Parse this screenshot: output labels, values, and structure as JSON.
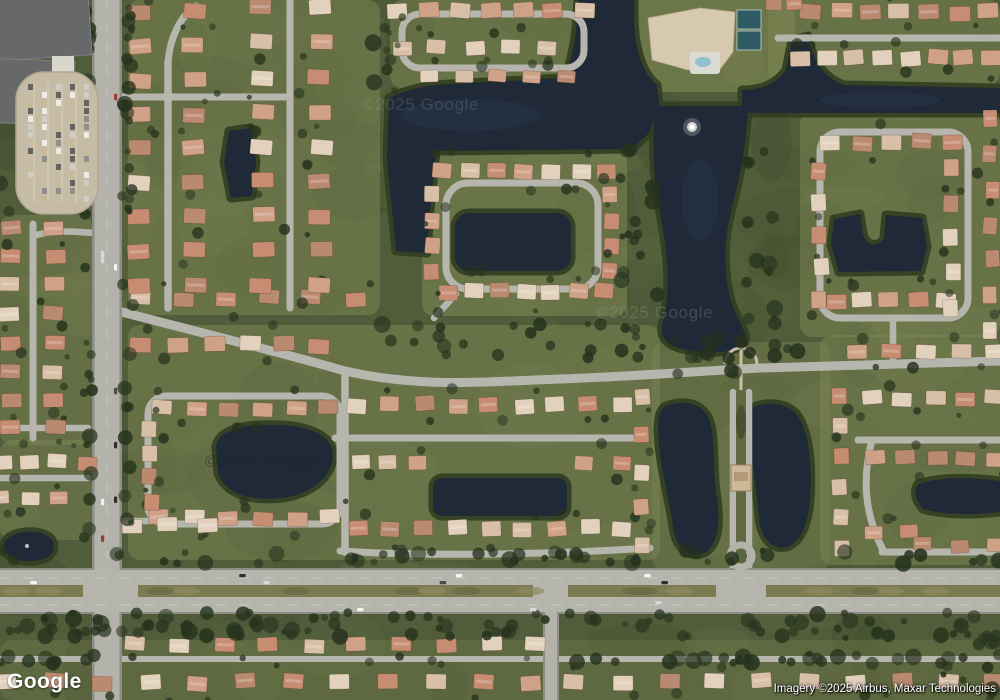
{
  "map": {
    "view_type": "satellite",
    "provider_logo": "Google",
    "attribution": "Imagery ©2025 Airbus, Maxar Technologies",
    "watermark": "©2025 Google",
    "palette": {
      "water": "#1f2937",
      "water_light": "#35425a",
      "shore": "#333f22",
      "vegetation": "#515c3a",
      "lawn": "#7e8854",
      "tree": "#26321d",
      "road": "#b7b6ae",
      "road_major": "#b4b3ab",
      "road_edge": "#8f8e86",
      "median": "#7d7b52",
      "roof_tan": "#d8bfa7",
      "roof_terracotta": "#c68d72",
      "roof_salmon": "#cfa186",
      "roof_light": "#e2d2bd",
      "roof_brown": "#b98a70",
      "building_gray": "#66686a",
      "parking": "#c6bca6",
      "tennis_court": "#2d5a63",
      "pool": "#8fc0d0",
      "fountain": "#ffffff",
      "path": "#cabfa6"
    }
  }
}
